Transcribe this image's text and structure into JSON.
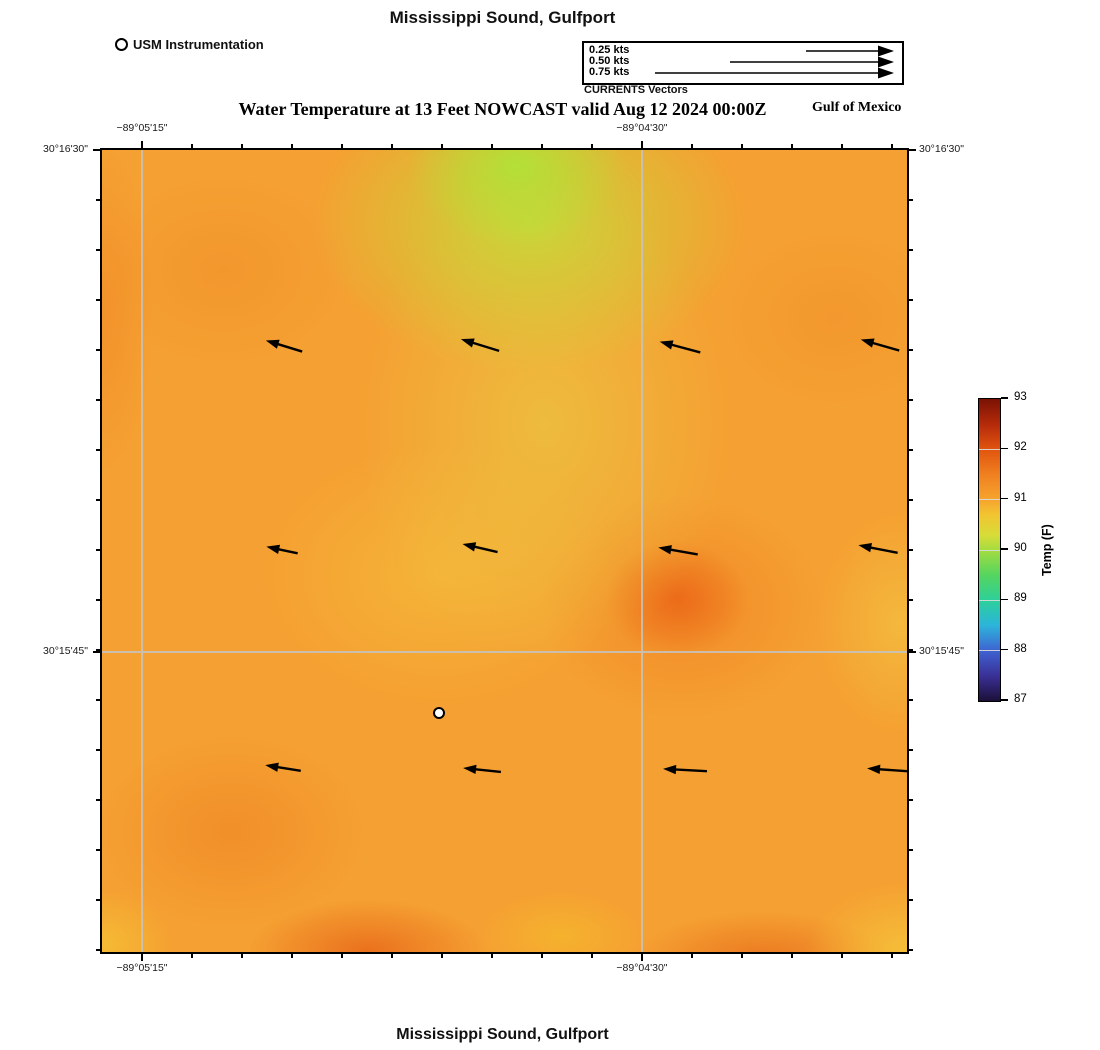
{
  "page": {
    "top_title": "Mississippi Sound, Gulfport",
    "bottom_title": "Mississippi Sound, Gulfport",
    "region_label": "Gulf of Mexico"
  },
  "station_legend": {
    "label": "USM Instrumentation",
    "marker": "open-circle"
  },
  "vector_legend": {
    "caption": "CURRENTS Vectors",
    "items": [
      {
        "label": "0.25 kts",
        "length_px": 86
      },
      {
        "label": "0.50 kts",
        "length_px": 162
      },
      {
        "label": "0.75 kts",
        "length_px": 237
      }
    ]
  },
  "chart_data": {
    "type": "heatmap",
    "title": "Mississippi Sound, Gulfport",
    "subtitle": "Water Temperature at 13 Feet NOWCAST valid Aug 12 2024 00:00Z",
    "field": "Water Temperature at 13 Feet",
    "mode": "NOWCAST",
    "valid_time": "Aug 12 2024 00:00Z",
    "axes": {
      "lon_ticks": [
        {
          "label": "−89°05'15\"",
          "frac": 0.0497
        },
        {
          "label": "−89°04'30\"",
          "frac": 0.6708
        }
      ],
      "lat_ticks": [
        {
          "label": "30°16'30\"",
          "frac": 0.0
        },
        {
          "label": "30°15'45\"",
          "frac": 0.626
        }
      ],
      "minor": {
        "x_start_px": 40,
        "x_step_px": 50,
        "x_count": 16,
        "y_start_px": 0,
        "y_step_px": 50,
        "y_count": 17
      },
      "grid": true
    },
    "colorbar": {
      "title": "Temp (F)",
      "min": 87,
      "max": 93,
      "ticks": [
        93,
        92,
        91,
        90,
        89,
        88,
        87
      ],
      "stops": [
        {
          "v": 93,
          "c": "#7a1204"
        },
        {
          "v": 92.5,
          "c": "#b42a0a"
        },
        {
          "v": 92,
          "c": "#e1540f"
        },
        {
          "v": 91.5,
          "c": "#f08020"
        },
        {
          "v": 91,
          "c": "#f6a42e"
        },
        {
          "v": 90.7,
          "c": "#f2c431"
        },
        {
          "v": 90.3,
          "c": "#d8dc38"
        },
        {
          "v": 90,
          "c": "#a4dc40"
        },
        {
          "v": 89.5,
          "c": "#55d55f"
        },
        {
          "v": 89,
          "c": "#2dd09b"
        },
        {
          "v": 88.5,
          "c": "#2cb4da"
        },
        {
          "v": 88,
          "c": "#3f63d2"
        },
        {
          "v": 87.5,
          "c": "#3a3096"
        },
        {
          "v": 87,
          "c": "#1c1038"
        }
      ]
    },
    "temperature_grid_f": {
      "note": "approximate values read from the color field; rows north to south, cols west to east",
      "values": [
        [
          91.3,
          91.1,
          90.2,
          90.8,
          91.4
        ],
        [
          91.4,
          91.2,
          90.6,
          91.4,
          91.6
        ],
        [
          91.3,
          91.0,
          90.9,
          92.0,
          91.0
        ],
        [
          91.5,
          91.4,
          91.1,
          91.5,
          90.9
        ],
        [
          91.1,
          92.0,
          91.3,
          92.0,
          90.8
        ]
      ]
    },
    "vectors": {
      "direction": "toward WNW (upper-left)",
      "approx_speed_kts_range": [
        0.1,
        0.15
      ],
      "arrows": [
        {
          "x": 182,
          "y": 196,
          "rot": 197,
          "len": 38
        },
        {
          "x": 378,
          "y": 195,
          "rot": 197,
          "len": 40
        },
        {
          "x": 578,
          "y": 197,
          "rot": 195,
          "len": 42
        },
        {
          "x": 778,
          "y": 195,
          "rot": 196,
          "len": 40
        },
        {
          "x": 180,
          "y": 400,
          "rot": 192,
          "len": 32
        },
        {
          "x": 378,
          "y": 398,
          "rot": 193,
          "len": 36
        },
        {
          "x": 576,
          "y": 401,
          "rot": 190,
          "len": 40
        },
        {
          "x": 776,
          "y": 399,
          "rot": 191,
          "len": 40
        },
        {
          "x": 181,
          "y": 618,
          "rot": 189,
          "len": 36
        },
        {
          "x": 380,
          "y": 620,
          "rot": 186,
          "len": 38
        },
        {
          "x": 583,
          "y": 620,
          "rot": 183,
          "len": 44
        },
        {
          "x": 788,
          "y": 620,
          "rot": 184,
          "len": 46
        }
      ]
    },
    "station": {
      "x": 337,
      "y": 563,
      "marker": "open-circle"
    }
  }
}
